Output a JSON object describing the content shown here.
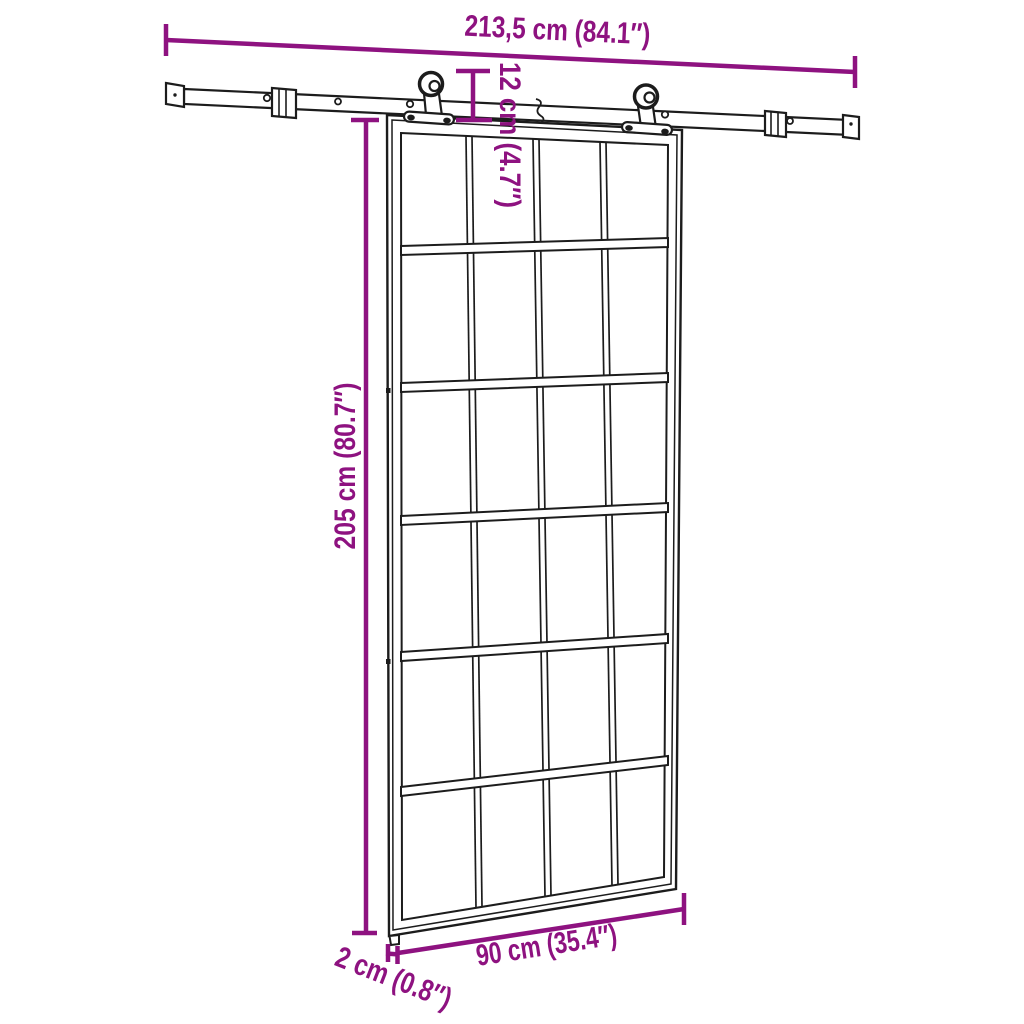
{
  "labels": {
    "rail_length": "213,5 cm (84.1″)",
    "hanger_drop": "12 cm (4.7″)",
    "door_height": "205 cm (80.7″)",
    "door_width": "90 cm (35.4″)",
    "door_thickness": "2 cm (0.8″)"
  },
  "colors": {
    "dimension_accent": "#8e1280",
    "line_art": "#1c1c1c",
    "background": "#ffffff"
  }
}
